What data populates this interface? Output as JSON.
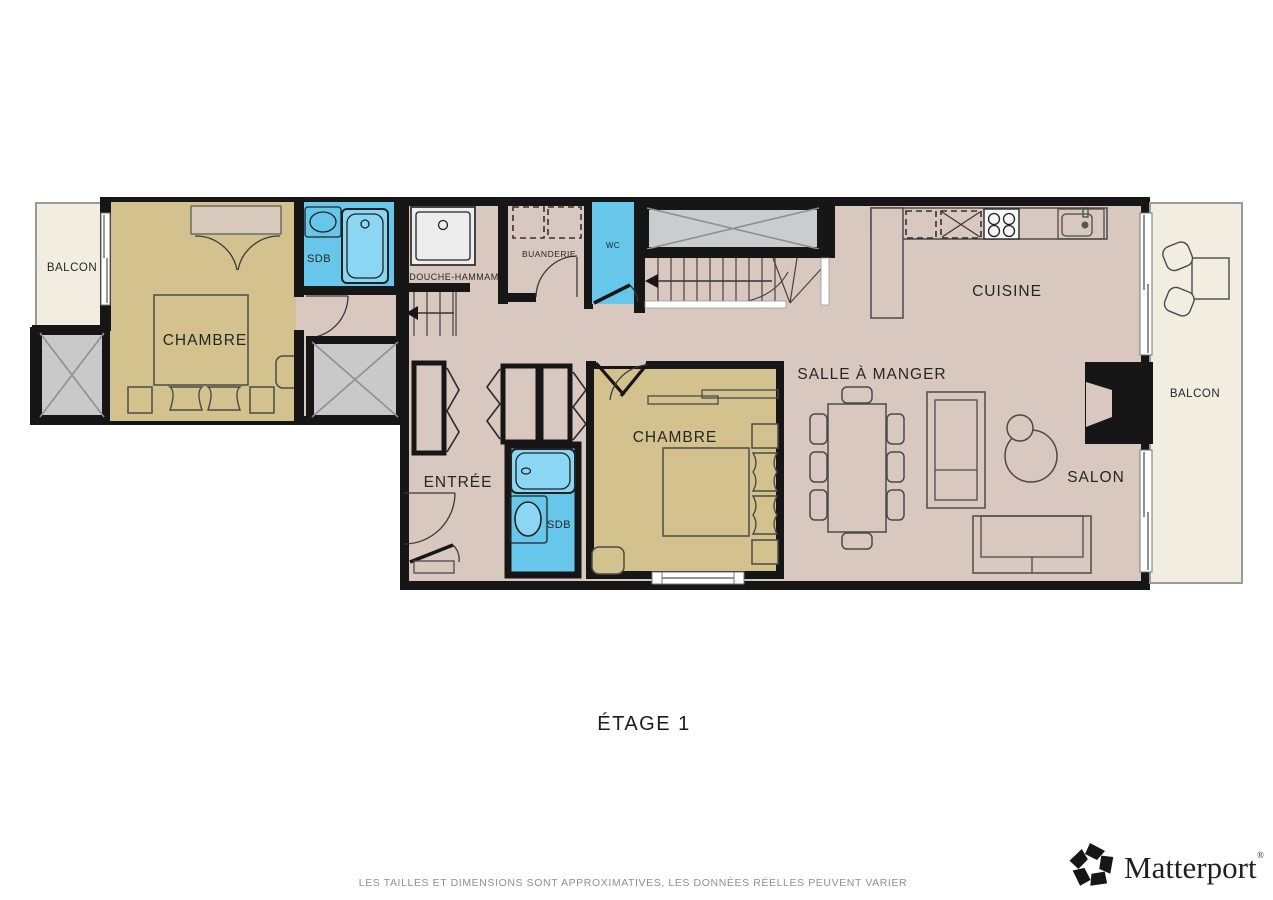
{
  "plan": {
    "floor_label": "ÉTAGE 1",
    "rooms": {
      "balcon_left": "BALCON",
      "chambre_1": "CHAMBRE",
      "sdb_1": "SDB",
      "douche_hammam": "DOUCHE-HAMMAM",
      "buanderie": "BUANDERIE",
      "wc": "WC",
      "cuisine": "CUISINE",
      "salle_a_manger": "SALLE À MANGER",
      "chambre_2": "CHAMBRE",
      "entree": "ENTRÉE",
      "sdb_2": "SDB",
      "salon": "SALON",
      "balcon_right": "BALCON"
    },
    "colors": {
      "wall": "#161616",
      "floor": "#d8c8c0",
      "bedroom_floor": "#d3c28d",
      "balcony_floor": "#f1eee1",
      "wet_room": "#66c7eb",
      "fixture_light": "#8ad6f3",
      "shaft_gray": "#c9c9c9",
      "background": "#ffffff"
    }
  },
  "footer": {
    "disclaimer": "LES TAILLES ET DIMENSIONS SONT APPROXIMATIVES, LES DONNÉES RÉELLES PEUVENT VARIER",
    "brand_name": "Matterport",
    "brand_registered_mark": "®"
  }
}
